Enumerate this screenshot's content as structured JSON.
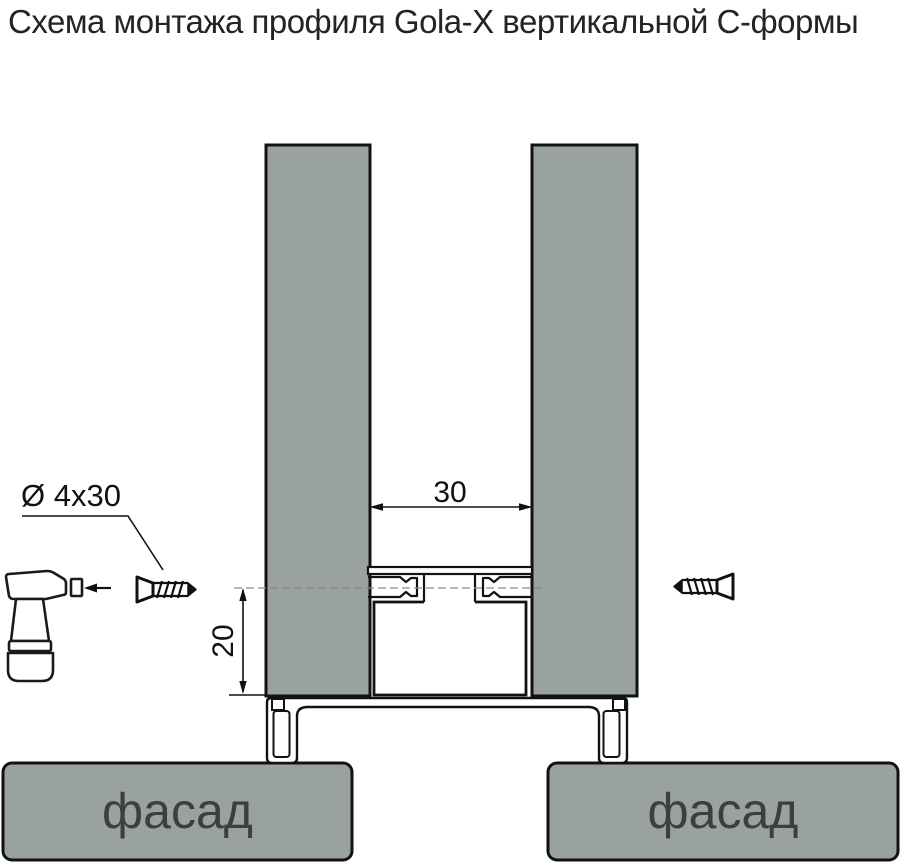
{
  "title": "Схема монтажа профиля Gola-X вертикальной С-формы",
  "labels": {
    "gap_width": "30",
    "overlap_height": "20",
    "screw_spec": "Ø 4x30",
    "facade_left": "фасад",
    "facade_right": "фасад"
  },
  "icons": {
    "drill": "cordless-screwdriver",
    "screw_left": "countersunk-screw-pointing-right",
    "screw_right": "countersunk-screw-pointing-left"
  },
  "colors": {
    "panel_fill": "#9aa29d",
    "outline": "#121212",
    "title_text": "#242424",
    "facade_text": "#3b403d",
    "dim_color": "#111111",
    "centerline": "#8a8a8a",
    "bg": "#ffffff"
  }
}
